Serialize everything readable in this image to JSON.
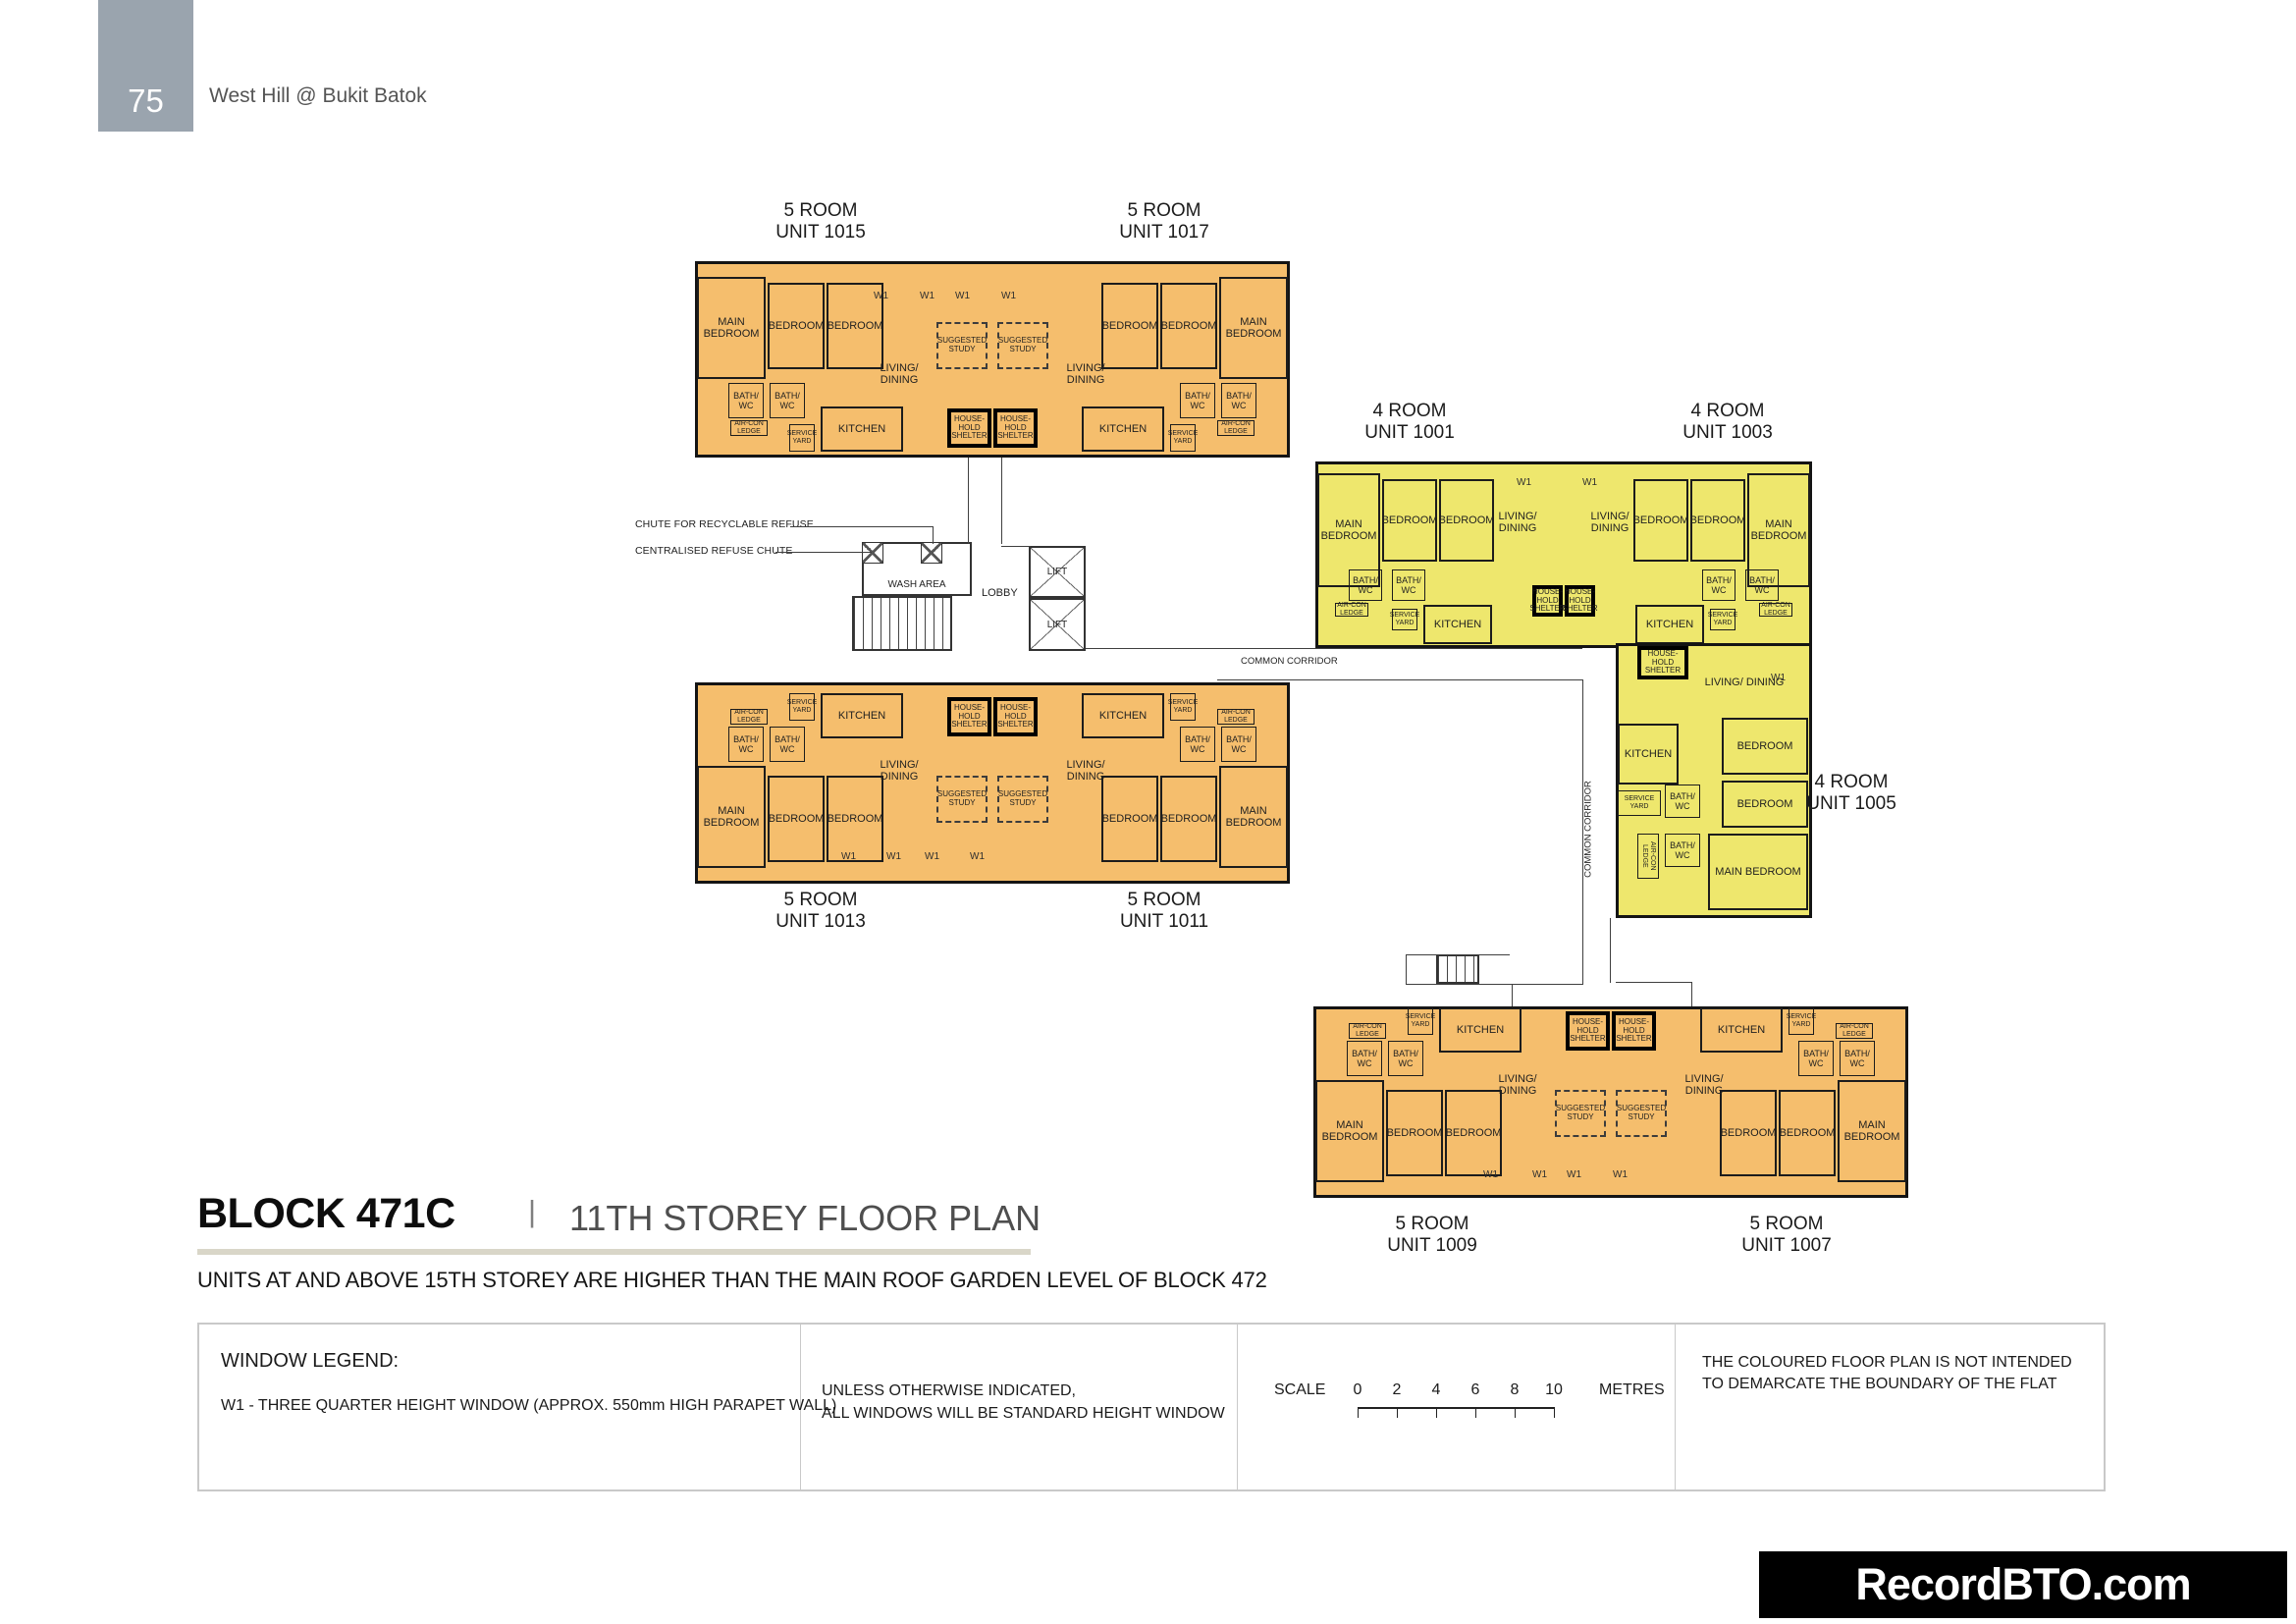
{
  "page": {
    "badge": "75",
    "project": "West Hill @ Bukit Batok"
  },
  "title": {
    "block": "BLOCK 471C",
    "divider": "|",
    "plan": "11TH STOREY FLOOR PLAN",
    "note": "UNITS AT AND ABOVE 15TH STOREY ARE HIGHER THAN THE MAIN ROOF GARDEN LEVEL OF BLOCK 472"
  },
  "units": [
    {
      "type": "5 ROOM",
      "unit": "UNIT 1015"
    },
    {
      "type": "5 ROOM",
      "unit": "UNIT 1017"
    },
    {
      "type": "4 ROOM",
      "unit": "UNIT 1001"
    },
    {
      "type": "4 ROOM",
      "unit": "UNIT 1003"
    },
    {
      "type": "4 ROOM",
      "unit": "UNIT 1005"
    },
    {
      "type": "5 ROOM",
      "unit": "UNIT 1013"
    },
    {
      "type": "5 ROOM",
      "unit": "UNIT 1011"
    },
    {
      "type": "5 ROOM",
      "unit": "UNIT 1009"
    },
    {
      "type": "5 ROOM",
      "unit": "UNIT 1007"
    }
  ],
  "room_labels": {
    "main_bedroom": "MAIN BEDROOM",
    "bedroom": "BEDROOM",
    "living_dining": "LIVING/ DINING",
    "kitchen": "KITCHEN",
    "bath_wc": "BATH/ WC",
    "household_shelter": "HOUSE- HOLD SHELTER",
    "suggested_study": "SUGGESTED STUDY",
    "service_yard": "SERVICE YARD",
    "aircon_ledge": "AIR-CON LEDGE"
  },
  "core_labels": {
    "w1": "W1",
    "wash_area": "WASH AREA",
    "lobby": "LOBBY",
    "lift": "LIFT",
    "common_corridor": "COMMON CORRIDOR",
    "chute_recyclable": "CHUTE FOR RECYCLABLE REFUSE",
    "centralised_chute": "CENTRALISED REFUSE CHUTE"
  },
  "legend": {
    "window_legend_title": "WINDOW LEGEND:",
    "w1_description": "W1 - THREE QUARTER HEIGHT WINDOW (APPROX. 550mm HIGH PARAPET WALL)",
    "windows_note_line1": "UNLESS OTHERWISE INDICATED,",
    "windows_note_line2": "ALL WINDOWS WILL BE STANDARD HEIGHT WINDOW",
    "scale_label": "SCALE",
    "scale_ticks": [
      "0",
      "2",
      "4",
      "6",
      "8",
      "10"
    ],
    "scale_unit": "METRES",
    "boundary_note_line1": "THE COLOURED FLOOR PLAN IS NOT INTENDED",
    "boundary_note_line2": "TO DEMARCATE THE BOUNDARY OF THE FLAT"
  },
  "footer": {
    "watermark": "RecordBTO.com"
  },
  "colors": {
    "five_room_fill": "#F5BE6D",
    "four_room_fill": "#EEE76D",
    "badge_bg": "#9AA4AE",
    "title_underline": "#D9D6C8",
    "watermark_bg": "#000000",
    "watermark_text": "#FFFFFF"
  }
}
